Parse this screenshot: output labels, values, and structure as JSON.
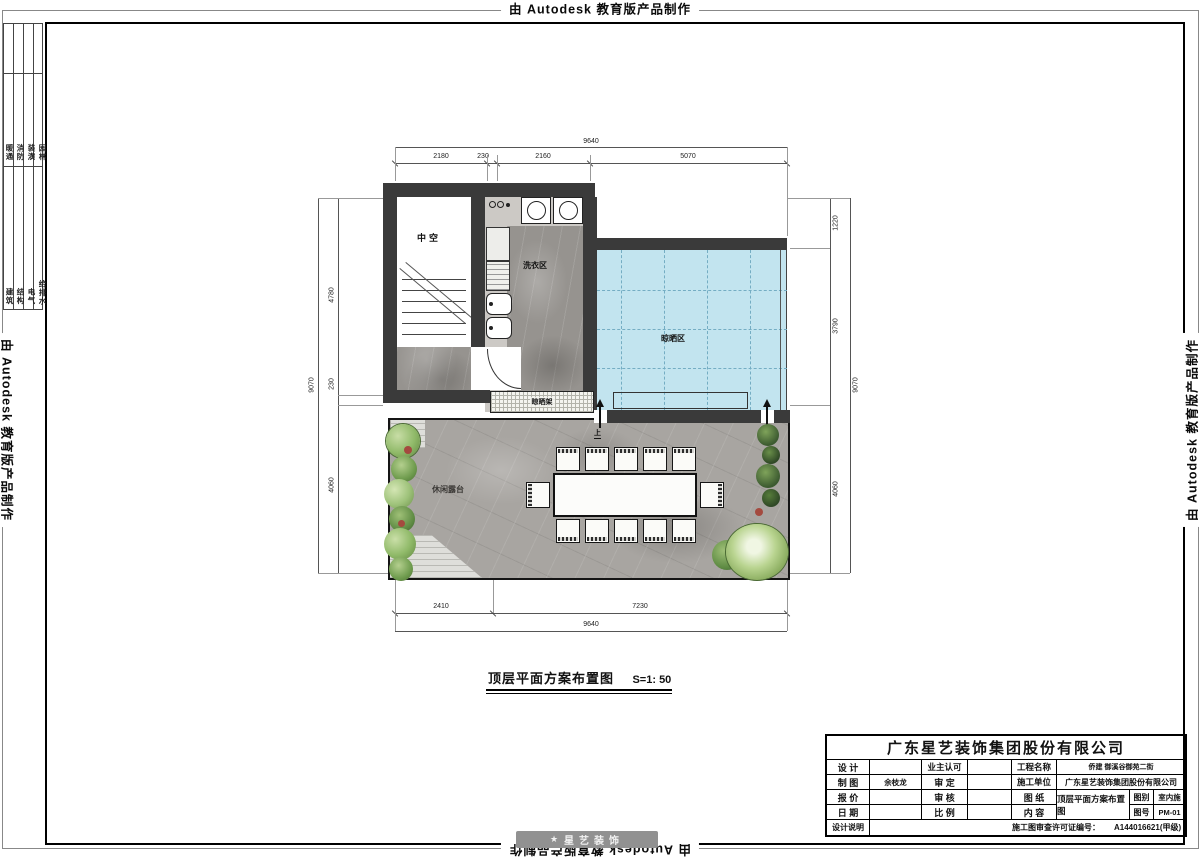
{
  "stamp": {
    "text": "由 Autodesk 教育版产品制作"
  },
  "sheet": {
    "disciplines_top": [
      "暖通",
      "消防",
      "装潢",
      "园林"
    ],
    "disciplines_bottom": [
      "建筑",
      "结构",
      "电气",
      "给排水"
    ]
  },
  "plan": {
    "rooms": {
      "void": "中空",
      "laundry": "洗衣区",
      "drying": "晾晒区",
      "drying_rack": "晾晒架",
      "terrace": "休闲露台"
    },
    "up_label": "上"
  },
  "dims": {
    "top": {
      "total": "9640",
      "segs": [
        "2180",
        "230",
        "2160",
        "5070"
      ]
    },
    "bottom": {
      "total": "9640",
      "segs": [
        "2410",
        "7230"
      ]
    },
    "left": {
      "total": "9070",
      "segs": [
        "4780",
        "230",
        "4060"
      ]
    },
    "right": {
      "total": "9070",
      "segs": [
        "1220",
        "3790",
        "4060"
      ]
    }
  },
  "caption": {
    "title": "顶层平面方案布置图",
    "scale": "S=1: 50"
  },
  "titleblock": {
    "company": "广东星艺装饰集团股份有限公司",
    "labels": {
      "design": "设 计",
      "draft": "制 图",
      "quote": "报 价",
      "date": "日 期",
      "notes": "设计说明",
      "owner_approval": "业主认可",
      "approve": "审 定",
      "check": "审 核",
      "scale": "比 例",
      "project_name": "工程名称",
      "contractor": "施工单位",
      "sheet": "图 纸",
      "content": "内 容",
      "category": "图别",
      "number": "图号"
    },
    "values": {
      "draft_by": "余枝龙",
      "project_name": "侨建 御溪谷御苑二街",
      "contractor": "广东星艺装饰集团股份有限公司",
      "content": "顶层平面方案布置图",
      "category": "室内施",
      "number": "PM-01",
      "permit_label": "施工图审查许可证编号：",
      "permit_no": "A144016621(甲级)"
    }
  },
  "watermark": {
    "logo": "★",
    "text": "星艺装饰"
  },
  "colors": {
    "wall": "#3a3a3a",
    "drying_blue": "#c2e4ef",
    "marble": "#a8a5a1",
    "green": "#6f9c4e"
  }
}
